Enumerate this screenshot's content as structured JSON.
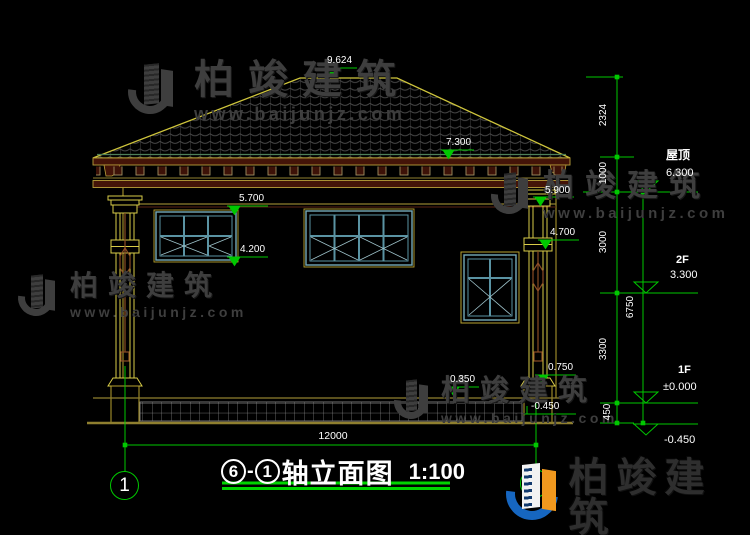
{
  "watermark": {
    "brand": "柏竣建筑",
    "url": "www.baijunjz.com"
  },
  "title": {
    "axis_from": "6",
    "dash": "-",
    "axis_to": "1",
    "name": "轴立面图",
    "scale": "1:100"
  },
  "axis_bubbles": {
    "left": "1",
    "right": "6"
  },
  "spot_levels": {
    "ridge": "9.624",
    "roof_eave": "7.300",
    "window_head": "5.700",
    "window_sill": "4.200",
    "capital_top": "5.900",
    "capital_bottom": "4.700",
    "column_base": "0.750",
    "wall_base": "0.350",
    "ground": "-0.450"
  },
  "story_levels": {
    "roof_label": "屋顶",
    "roof": "6.300",
    "f2_label": "2F",
    "f2": "3.300",
    "f1_label": "1F",
    "f1": "±0.000",
    "foundation": "-0.450"
  },
  "dims": {
    "ridge_to_eave": "2324",
    "eave_to_roof_level": "1000",
    "roof_to_f2": "3000",
    "f2_to_f1": "3300",
    "f1_to_found": "450",
    "total_height": "6750",
    "total_width": "12000"
  }
}
